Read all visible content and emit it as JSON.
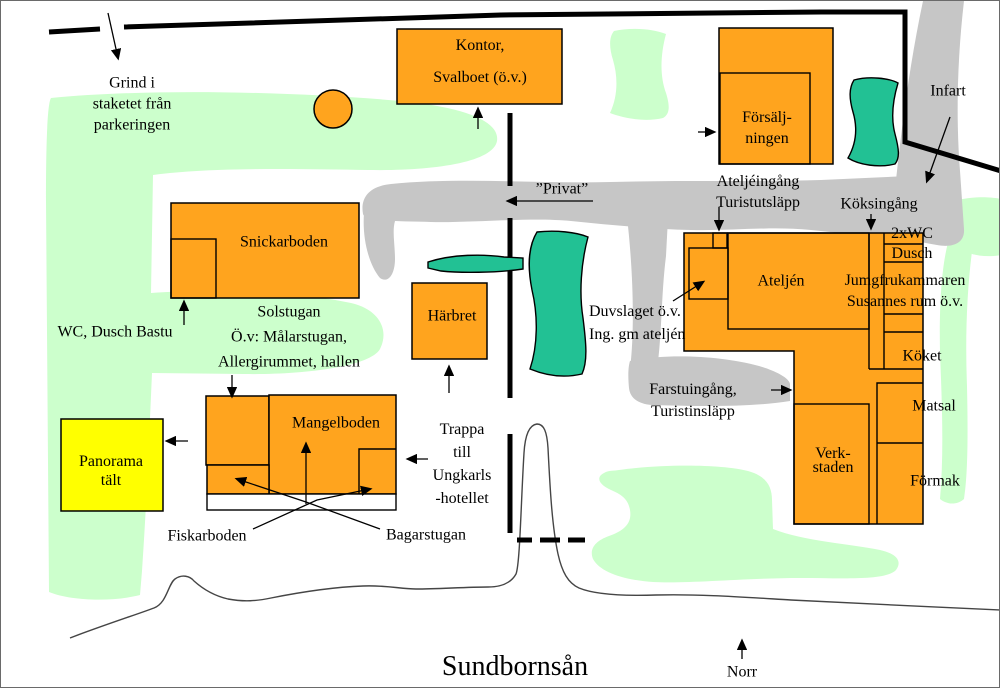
{
  "colors": {
    "building": "#FFA41E",
    "tent": "#FFFF00",
    "grass": "#CCFFCC",
    "water": "#22C194",
    "road": "#C6C6C6"
  },
  "labels": {
    "gate": "Grind i\nstaketet från\nparkeringen",
    "kontor": "Kontor,\nSvalboet (ö.v.)",
    "forsaljningen": "Försälj-\nningen",
    "infart": "Infart",
    "ateljeingang": "Ateljéingång\nTuristutsläpp",
    "koksingang": "Köksingång",
    "privat": "”Privat”",
    "wc_dusch": "2xWC\nDusch",
    "jungfrukammaren": "Jumgfrukammaren\nSusannes rum ö.v.",
    "ateljen": "Ateljén",
    "snickarboden": "Snickarboden",
    "wc_dusch_bastu": "WC, Dusch Bastu",
    "solstugan": "Solstugan\nÖ.v: Målarstugan,\nAllergirummet, hallen",
    "duvslaget": "Duvslaget ö.v.\nIng. gm ateljén",
    "harbret": "Härbret",
    "koket": "Köket",
    "matsal": "Matsal",
    "formak": "Förmak",
    "verkstaden": "Verk-\nstaden",
    "farstuingang": "Farstuingång,\nTuristinsläpp",
    "mangelboden": "Mangelboden",
    "trappa": "Trappa\ntill\nUngkarls\n-hotellet",
    "panorama": "Panorama\ntält",
    "fiskarboden": "Fiskarboden",
    "bagarstugan": "Bagarstugan",
    "river": "Sundbornsån",
    "north": "Norr"
  }
}
